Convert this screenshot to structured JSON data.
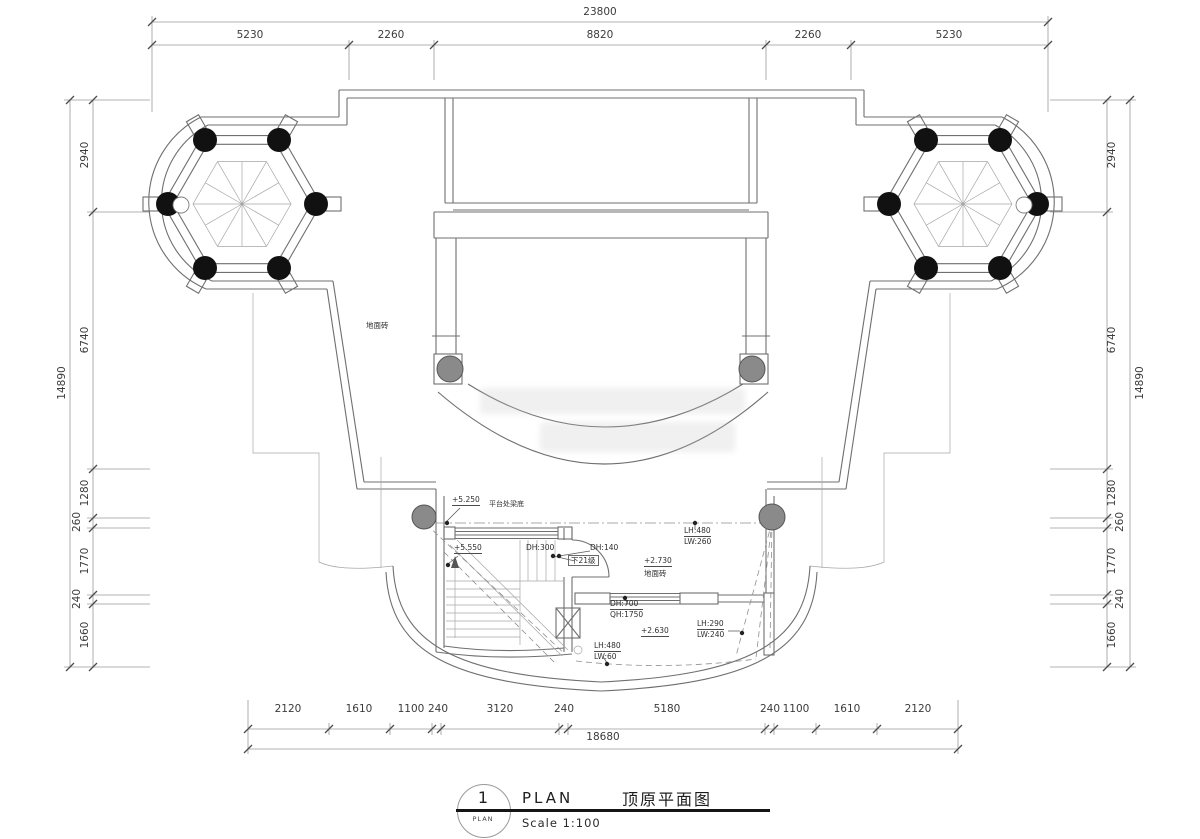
{
  "colors": {
    "background": "#ffffff",
    "wall_line": "#6f6f6f",
    "column_black": "#111111",
    "column_gray": "#8a8a8a",
    "text": "#3b3b3b"
  },
  "dimensions": {
    "top": {
      "total": "23800",
      "segments": [
        "5230",
        "2260",
        "8820",
        "2260",
        "5230"
      ]
    },
    "bottom": {
      "total": "18680",
      "segments": [
        "2120",
        "1610",
        "1100",
        "240",
        "3120",
        "240",
        "5180",
        "240",
        "1100",
        "1610",
        "2120"
      ]
    },
    "left": {
      "total": "14890",
      "segments": [
        "2940",
        "6740",
        "1280",
        "260",
        "1770",
        "240",
        "1660"
      ]
    },
    "right": {
      "total": "14890",
      "segments": [
        "2940",
        "6740",
        "1280",
        "260",
        "1770",
        "240",
        "1660"
      ]
    }
  },
  "annotations": {
    "deck_floor_tile": "地面砖",
    "platform_level": "+5.250",
    "platform_beam": "平台处梁底",
    "stair_level": "+5.550",
    "dh300": "DH:300",
    "dh140": "DH:140",
    "down_steps": "下21级",
    "room_level": "+2.730",
    "room_floor_tile": "地面砖",
    "win_right": {
      "top": "LH:480",
      "bot": "LW:260"
    },
    "win_mid": {
      "top": "DH:700",
      "bot": "QH:1750"
    },
    "level_2630": "+2.630",
    "win_se": {
      "top": "LH:290",
      "bot": "LW:240"
    },
    "win_bottom": {
      "top": "LH:480",
      "bot": "LW:60"
    }
  },
  "title_block": {
    "number": "1",
    "circle_caption": "PLAN",
    "title_en": "PLAN",
    "title_cn": "顶原平面图",
    "scale": "Scale 1:100"
  }
}
